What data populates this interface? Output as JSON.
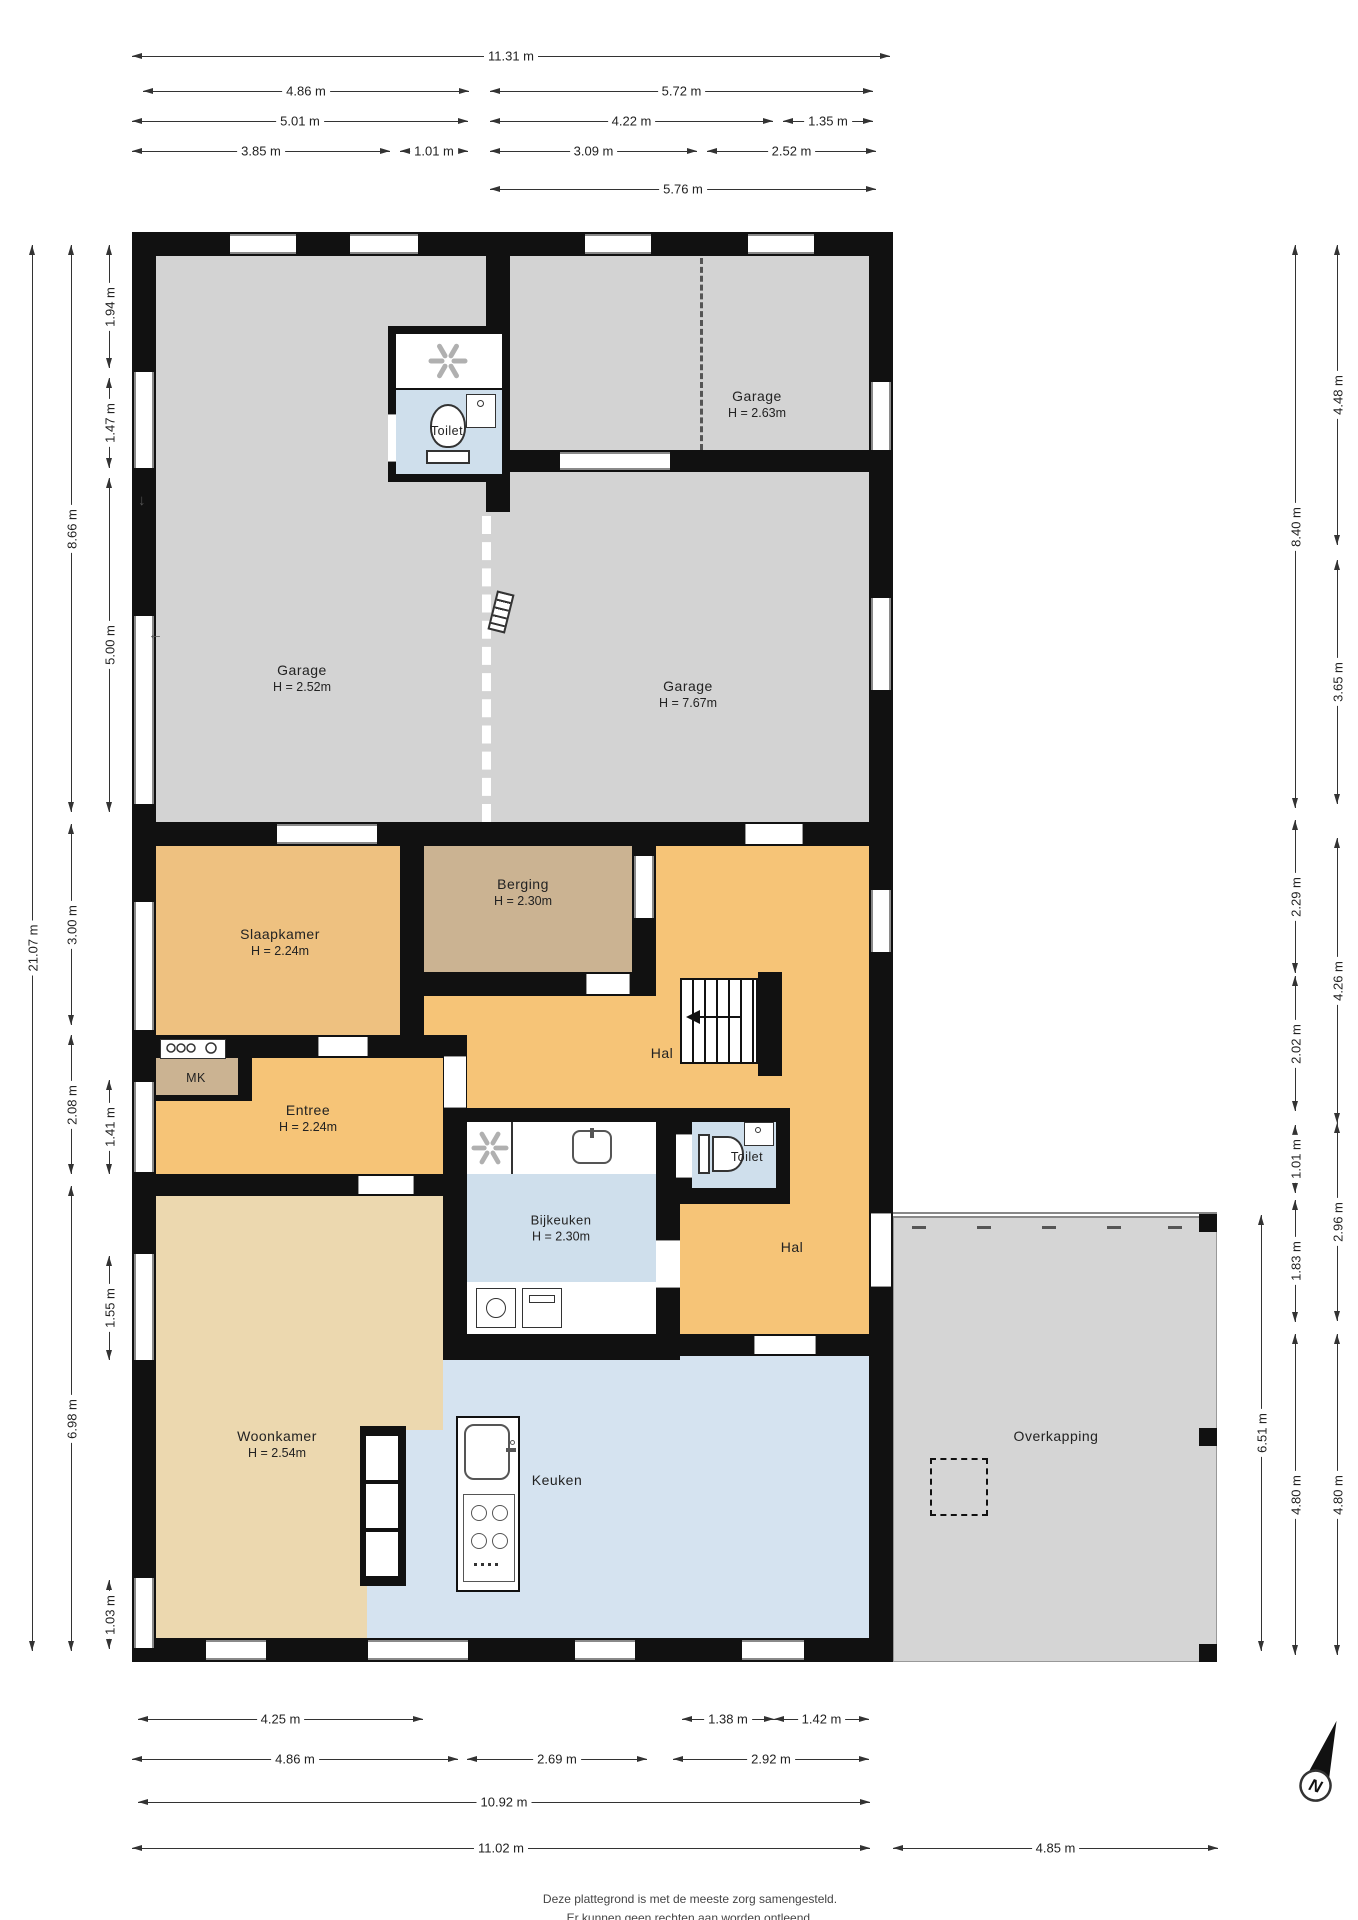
{
  "title": "Plattegrond begane grond",
  "rooms": {
    "garage_left": {
      "name": "Garage",
      "height": "H = 2.52m"
    },
    "garage_top_right": {
      "name": "Garage",
      "height": "H = 2.63m"
    },
    "garage_mid": {
      "name": "Garage",
      "height": "H = 7.67m"
    },
    "toilet_boven": {
      "name": "Toilet"
    },
    "slaapkamer": {
      "name": "Slaapkamer",
      "height": "H = 2.24m"
    },
    "berging": {
      "name": "Berging",
      "height": "H = 2.30m"
    },
    "hal_boven": {
      "name": "Hal"
    },
    "mk": {
      "name": "MK"
    },
    "entree": {
      "name": "Entree",
      "height": "H = 2.24m"
    },
    "bijkeuken": {
      "name": "Bijkeuken",
      "height": "H = 2.30m"
    },
    "toilet_beneden": {
      "name": "Toilet"
    },
    "hal_beneden": {
      "name": "Hal"
    },
    "woonkamer": {
      "name": "Woonkamer",
      "height": "H = 2.54m"
    },
    "keuken": {
      "name": "Keuken"
    },
    "overkapping": {
      "name": "Overkapping"
    }
  },
  "dimensions": {
    "top": [
      {
        "label": "11.31 m",
        "x": 132,
        "y": 57,
        "len": 758
      },
      {
        "label": "4.86 m",
        "x": 143,
        "y": 92,
        "len": 326
      },
      {
        "label": "5.72 m",
        "x": 490,
        "y": 92,
        "len": 383
      },
      {
        "label": "5.01 m",
        "x": 132,
        "y": 122,
        "len": 336
      },
      {
        "label": "4.22 m",
        "x": 490,
        "y": 122,
        "len": 283
      },
      {
        "label": "1.35 m",
        "x": 783,
        "y": 122,
        "len": 90
      },
      {
        "label": "3.85 m",
        "x": 132,
        "y": 152,
        "len": 258
      },
      {
        "label": "1.01 m",
        "x": 400,
        "y": 152,
        "len": 68
      },
      {
        "label": "3.09 m",
        "x": 490,
        "y": 152,
        "len": 207
      },
      {
        "label": "2.52 m",
        "x": 707,
        "y": 152,
        "len": 169
      },
      {
        "label": "5.76 m",
        "x": 490,
        "y": 190,
        "len": 386
      }
    ],
    "bottom": [
      {
        "label": "4.25 m",
        "x": 138,
        "y": 1720,
        "len": 285
      },
      {
        "label": "1.38 m",
        "x": 682,
        "y": 1720,
        "len": 92
      },
      {
        "label": "1.42 m",
        "x": 774,
        "y": 1720,
        "len": 95
      },
      {
        "label": "4.86 m",
        "x": 132,
        "y": 1760,
        "len": 326
      },
      {
        "label": "2.69 m",
        "x": 467,
        "y": 1760,
        "len": 180
      },
      {
        "label": "2.92 m",
        "x": 673,
        "y": 1760,
        "len": 196
      },
      {
        "label": "10.92 m",
        "x": 138,
        "y": 1803,
        "len": 732
      },
      {
        "label": "11.02 m",
        "x": 132,
        "y": 1849,
        "len": 738
      },
      {
        "label": "4.85 m",
        "x": 893,
        "y": 1849,
        "len": 325
      }
    ],
    "left": [
      {
        "label": "21.07 m",
        "x": 33,
        "y": 245,
        "len": 1406
      },
      {
        "label": "8.66 m",
        "x": 72,
        "y": 245,
        "len": 567
      },
      {
        "label": "3.00 m",
        "x": 72,
        "y": 824,
        "len": 201
      },
      {
        "label": "2.08 m",
        "x": 72,
        "y": 1035,
        "len": 139
      },
      {
        "label": "6.98 m",
        "x": 72,
        "y": 1186,
        "len": 465
      },
      {
        "label": "1.94 m",
        "x": 110,
        "y": 245,
        "len": 123
      },
      {
        "label": "1.47 m",
        "x": 110,
        "y": 378,
        "len": 90
      },
      {
        "label": "5.00 m",
        "x": 110,
        "y": 478,
        "len": 334
      },
      {
        "label": "1.41 m",
        "x": 110,
        "y": 1080,
        "len": 94
      },
      {
        "label": "1.55 m",
        "x": 110,
        "y": 1256,
        "len": 104
      },
      {
        "label": "1.03 m",
        "x": 110,
        "y": 1580,
        "len": 69
      }
    ],
    "right": [
      {
        "label": "6.51 m",
        "x": 1262,
        "y": 1215,
        "len": 436
      },
      {
        "label": "8.40 m",
        "x": 1296,
        "y": 245,
        "len": 563
      },
      {
        "label": "2.29 m",
        "x": 1296,
        "y": 820,
        "len": 153
      },
      {
        "label": "2.02 m",
        "x": 1296,
        "y": 976,
        "len": 135
      },
      {
        "label": "1.01 m",
        "x": 1296,
        "y": 1125,
        "len": 68
      },
      {
        "label": "1.83 m",
        "x": 1296,
        "y": 1200,
        "len": 122
      },
      {
        "label": "4.80 m",
        "x": 1296,
        "y": 1334,
        "len": 321
      },
      {
        "label": "4.48 m",
        "x": 1338,
        "y": 245,
        "len": 300
      },
      {
        "label": "3.65 m",
        "x": 1338,
        "y": 560,
        "len": 244
      },
      {
        "label": "4.26 m",
        "x": 1338,
        "y": 838,
        "len": 285
      },
      {
        "label": "2.96 m",
        "x": 1338,
        "y": 1123,
        "len": 198
      },
      {
        "label": "4.80 m",
        "x": 1338,
        "y": 1334,
        "len": 321
      }
    ]
  },
  "compass": {
    "label": "N"
  },
  "footer": {
    "line1": "Deze plattegrond is met de meeste zorg samengesteld.",
    "line2": "Er kunnen geen rechten aan worden ontleend."
  },
  "colors": {
    "wall": "#111111",
    "garage": "#d3d3d3",
    "hal_orange": "#f6c477",
    "slaapkamer_orange": "#eec180",
    "berging_tan": "#cbb392",
    "woonkamer_beige": "#ecd8af",
    "keuken_blue": "#d5e3f0",
    "toilet_blue": "#cfdfec",
    "overkapping_gray": "#d5d5d5"
  }
}
